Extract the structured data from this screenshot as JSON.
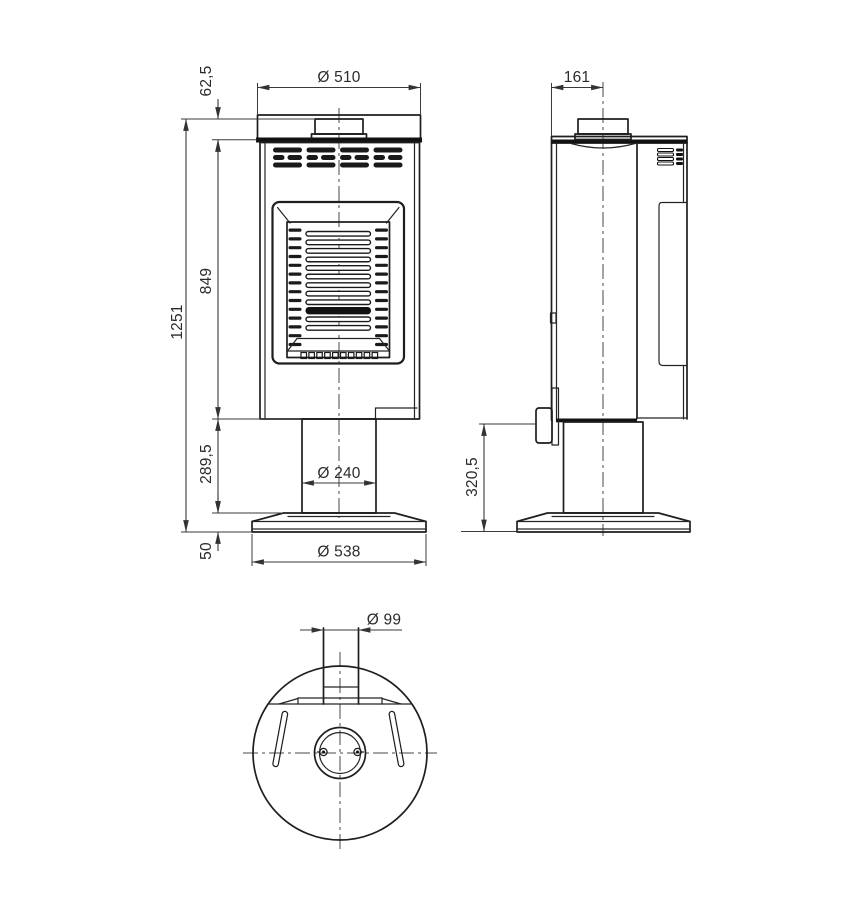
{
  "drawing": {
    "kind": "technical-dimension-drawing",
    "subject": "pedestal-stove-three-views"
  },
  "colors": {
    "background": "#ffffff",
    "outline": "#1e1e1e",
    "dimension": "#3a3a3a",
    "text": "#2b2b2b"
  },
  "dims": {
    "front": {
      "diameter_top": "Ø 510",
      "collar_height": "62,5",
      "total_height": "1251",
      "body_height": "849",
      "pedestal_height": "289,5",
      "base_height": "50",
      "pedestal_diameter": "Ø 240",
      "base_diameter": "Ø 538"
    },
    "side": {
      "flue_center_offset": "161",
      "handle_height": "320,5"
    },
    "bottom": {
      "duct_diameter": "Ø 99"
    }
  },
  "patterns": {
    "front_grille": {
      "columns": 4,
      "rows": 3
    },
    "door_louvers": {
      "count": 12,
      "solid_index": 10
    },
    "door_side_slats": {
      "count": 14
    },
    "door_grate": {
      "count": 10
    },
    "side_vents": {
      "rows": 4
    }
  }
}
